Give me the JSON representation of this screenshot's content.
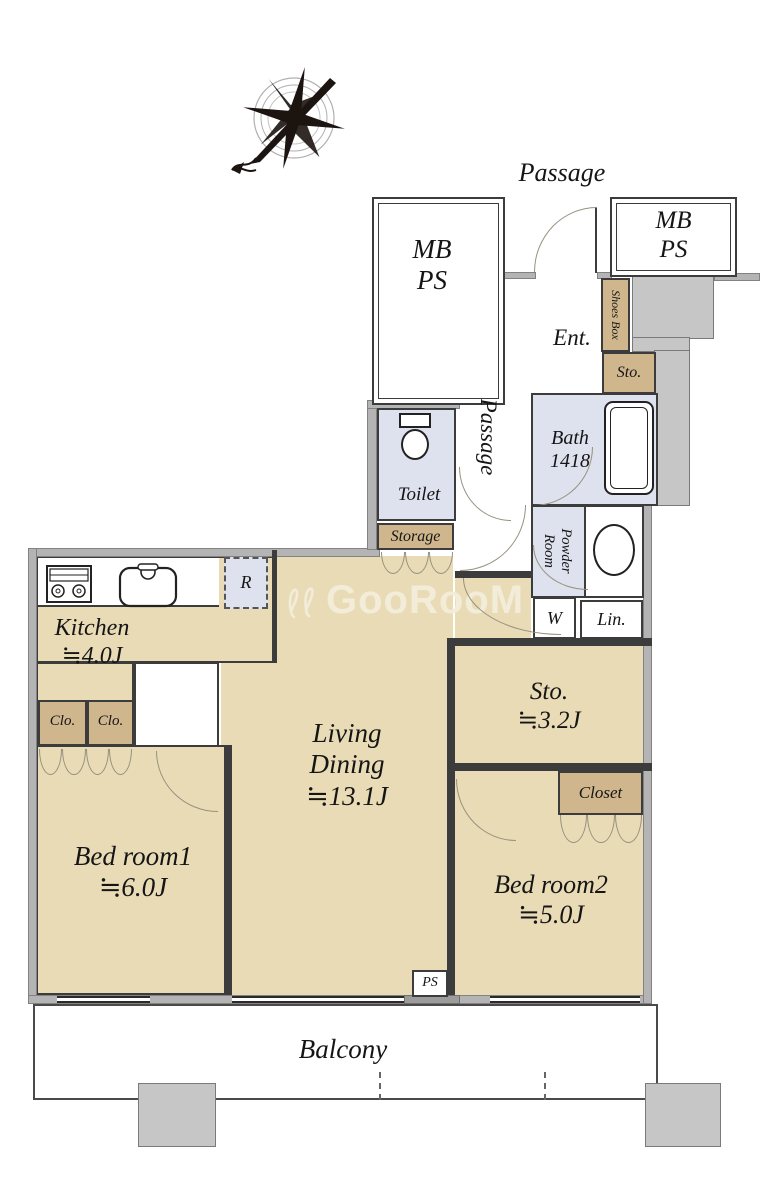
{
  "header": {
    "outside_passage": "Passage"
  },
  "mb_ps_left": {
    "line1": "MB",
    "line2": "PS"
  },
  "mb_ps_right": {
    "line1": "MB",
    "line2": "PS"
  },
  "entrance": {
    "ent": "Ent.",
    "shoes_box": "Shoes Box",
    "sto": "Sto."
  },
  "hall": {
    "passage": "Passage"
  },
  "sanitary": {
    "toilet": "Toilet",
    "bath_line1": "Bath",
    "bath_line2": "1418",
    "powder_line1": "Powder",
    "powder_line2": "Room",
    "washer": "W",
    "linen": "Lin.",
    "storage": "Storage"
  },
  "kitchen": {
    "name": "Kitchen",
    "size": "≒4.0J",
    "fridge": "R"
  },
  "closets": {
    "clo_left": "Clo.",
    "clo_right": "Clo.",
    "closet": "Closet"
  },
  "living": {
    "line1": "Living",
    "line2": "Dining",
    "size": "≒13.1J"
  },
  "sto_room": {
    "name": "Sto.",
    "size": "≒3.2J"
  },
  "bedroom1": {
    "name": "Bed room1",
    "size": "≒6.0J"
  },
  "bedroom2": {
    "name": "Bed room2",
    "size": "≒5.0J"
  },
  "balcony": {
    "name": "Balcony",
    "ps": "PS"
  },
  "watermark": "GooRooM",
  "colors": {
    "floor_tan": "#e9dbb6",
    "closet_tan": "#cfb68c",
    "wet_blue": "#dee1ee",
    "concrete_gray": "#c6c6c6",
    "heavy_wall_gray": "#b4b4b4"
  }
}
